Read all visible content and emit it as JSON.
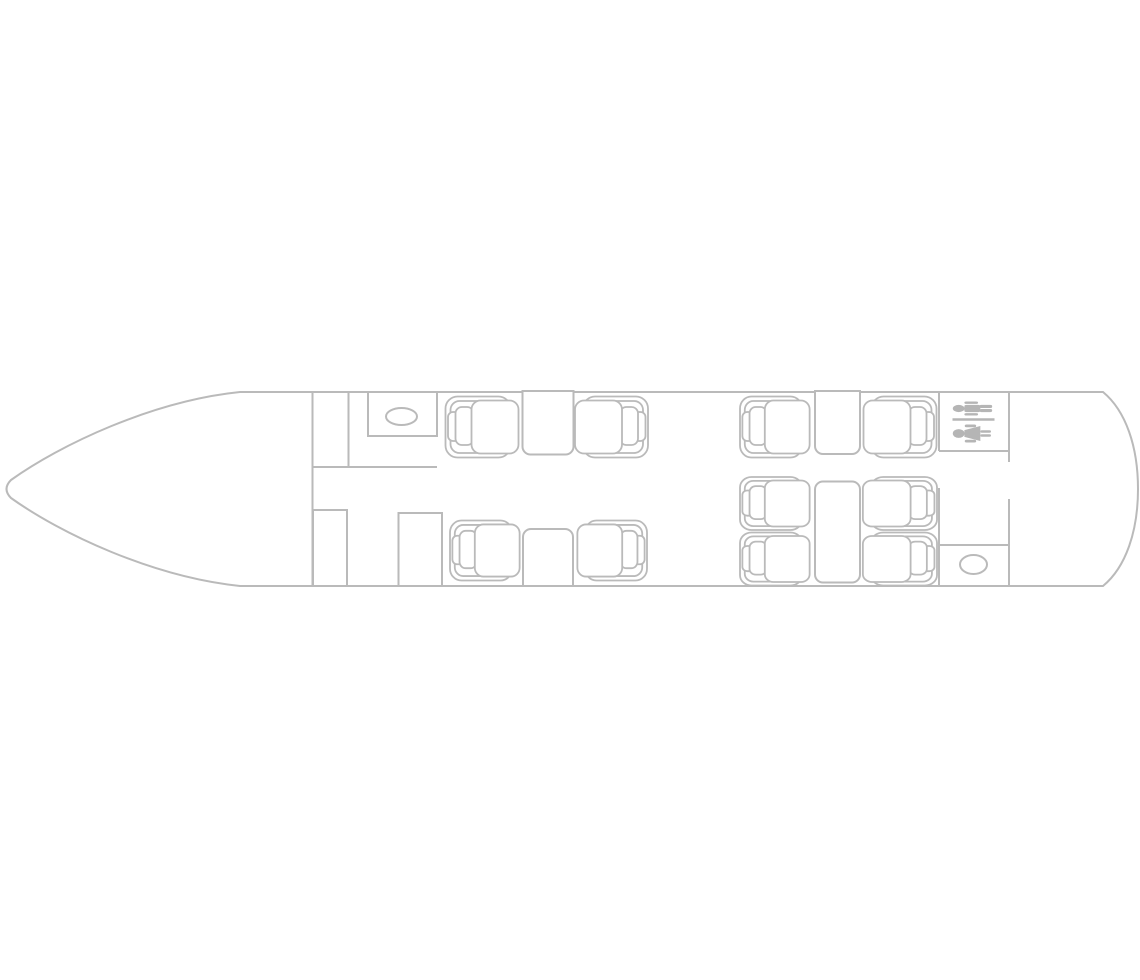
{
  "canvas": {
    "width": 1140,
    "height": 980,
    "background": "#ffffff"
  },
  "floorplan": {
    "kind": "aircraft-cabin-seating-layout",
    "stroke_color": "#bababa",
    "fill_color": "#ffffff",
    "sign_color": "#b5b5b5",
    "fuselage_path": "M 240,392 L 1103,392 C 1126,411 1138,447 1138,489 C 1138,531 1126,567 1103,586 L 240,586 C 152,577 60,533 11,498 Q 2,489 11,480 C 60,445 152,401 240,392 Z",
    "walls": [
      {
        "name": "forward-bulkhead",
        "x1": 312.5,
        "y1": 392,
        "x2": 312.5,
        "y2": 586
      },
      {
        "name": "entry-partition",
        "x1": 348.5,
        "y1": 392,
        "x2": 348.5,
        "y2": 467
      },
      {
        "name": "galley-aft-wall",
        "x1": 312.5,
        "y1": 467,
        "x2": 437,
        "y2": 467
      },
      {
        "name": "aft-bulkhead-upper",
        "x1": 939,
        "y1": 392,
        "x2": 939,
        "y2": 451
      },
      {
        "name": "aft-bulkhead-lower",
        "x1": 939,
        "y1": 488,
        "x2": 939,
        "y2": 586
      },
      {
        "name": "lavatory-aft-wall",
        "x1": 939,
        "y1": 451,
        "x2": 1009,
        "y2": 451
      },
      {
        "name": "rear-bulkhead-upper",
        "x1": 1009,
        "y1": 392,
        "x2": 1009,
        "y2": 462
      },
      {
        "name": "rear-bulkhead-lower",
        "x1": 1009,
        "y1": 499,
        "x2": 1009,
        "y2": 586
      },
      {
        "name": "aft-galley-forward-wall",
        "x1": 939,
        "y1": 545,
        "x2": 1009,
        "y2": 545
      }
    ],
    "cabinets": [
      {
        "name": "galley-counter",
        "x": 368,
        "y": 392,
        "w": 69,
        "h": 44
      },
      {
        "name": "wardrobe-forward-left",
        "x": 313,
        "y": 510,
        "w": 34,
        "h": 76
      },
      {
        "name": "wardrobe-forward-right",
        "x": 398.5,
        "y": 513,
        "w": 43.5,
        "h": 73
      }
    ],
    "basins": [
      {
        "name": "galley-sink",
        "cx": 401.5,
        "cy": 416.5,
        "rx": 15.5,
        "ry": 8.5
      },
      {
        "name": "lavatory-toilet",
        "cx": 973.5,
        "cy": 564.5,
        "rx": 13.5,
        "ry": 9.5
      }
    ],
    "tables": [
      {
        "name": "table-forward-club-top",
        "x": 522.5,
        "y": 391,
        "w": 51,
        "h": 63.5,
        "rounded": "bottom"
      },
      {
        "name": "table-forward-club-bottom",
        "x": 523,
        "y": 529,
        "w": 50,
        "h": 57,
        "rounded": "top"
      },
      {
        "name": "table-mid-club-top",
        "x": 815,
        "y": 391,
        "w": 45,
        "h": 63,
        "rounded": "bottom"
      },
      {
        "name": "table-aft-conference",
        "x": 815,
        "y": 481.5,
        "w": 45,
        "h": 101,
        "rounded": "all"
      }
    ],
    "seats": [
      {
        "id": "seat-1",
        "x": 445.5,
        "y": 396.5,
        "w": 65,
        "h": 61,
        "facing": "right"
      },
      {
        "id": "seat-2",
        "x": 583,
        "y": 396.5,
        "w": 65,
        "h": 61,
        "facing": "left"
      },
      {
        "id": "seat-3",
        "x": 450,
        "y": 520.5,
        "w": 62,
        "h": 60,
        "facing": "right"
      },
      {
        "id": "seat-4",
        "x": 585,
        "y": 520.5,
        "w": 62,
        "h": 60,
        "facing": "left"
      },
      {
        "id": "seat-5",
        "x": 740,
        "y": 396.5,
        "w": 62,
        "h": 61,
        "facing": "right"
      },
      {
        "id": "seat-6",
        "x": 871.5,
        "y": 396.5,
        "w": 65,
        "h": 61,
        "facing": "left"
      },
      {
        "id": "seat-7",
        "x": 740,
        "y": 477,
        "w": 62,
        "h": 53,
        "facing": "right"
      },
      {
        "id": "seat-8",
        "x": 871,
        "y": 477,
        "w": 66,
        "h": 53,
        "facing": "left"
      },
      {
        "id": "seat-9",
        "x": 740,
        "y": 532.5,
        "w": 62,
        "h": 53,
        "facing": "right"
      },
      {
        "id": "seat-10",
        "x": 871,
        "y": 532.5,
        "w": 66,
        "h": 53,
        "facing": "left"
      }
    ],
    "lavatory_sign": {
      "cx": 973.5,
      "cy": 421.5,
      "half_width": 21
    }
  }
}
